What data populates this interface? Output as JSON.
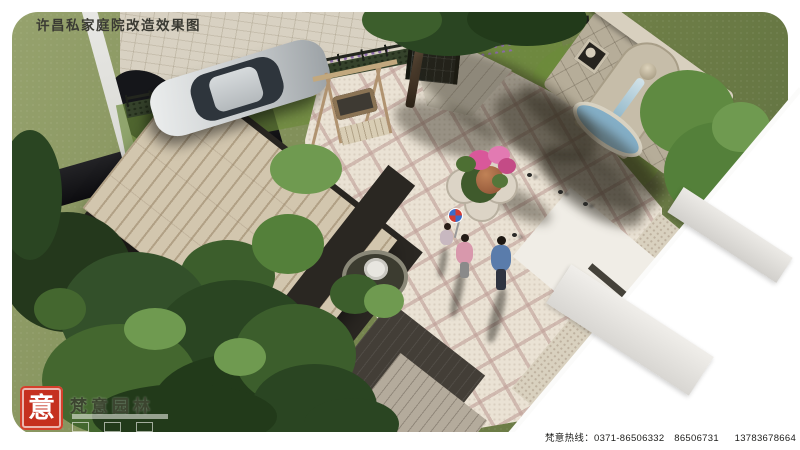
{
  "title": "许昌私家庭院改造效果图",
  "footer": {
    "hotline": "梵意热线：0371-86506332　86506731　  13783678664（田）"
  },
  "logo": {
    "seal_character": "意",
    "company_name": "梵意园林"
  },
  "scene": {
    "type": "private-courtyard-renovation-aerial-rendering",
    "elements": [
      "silver-car",
      "driveway",
      "boundary-wall",
      "hedge-and-fence",
      "entry-gate",
      "large-wooden-deck",
      "swing-bench",
      "stone-fountain-wall",
      "diamond-paved-plaza",
      "quatrefoil-flower-planter",
      "pond-bowl",
      "man-figure",
      "woman-figure",
      "child-with-pinwheel",
      "pigeons",
      "trees"
    ],
    "colors": {
      "seal_red": "#c5301f",
      "grass": "#75844e",
      "plaza_paving": "#eae2d4",
      "plaza_grid": "#bf9f98",
      "deck_wood": "#d2c6ae",
      "dark_wood": "#433e37",
      "fountain_stone": "#b6ad99",
      "water": "#8fb8cc",
      "canvas": "#ffffff"
    }
  }
}
